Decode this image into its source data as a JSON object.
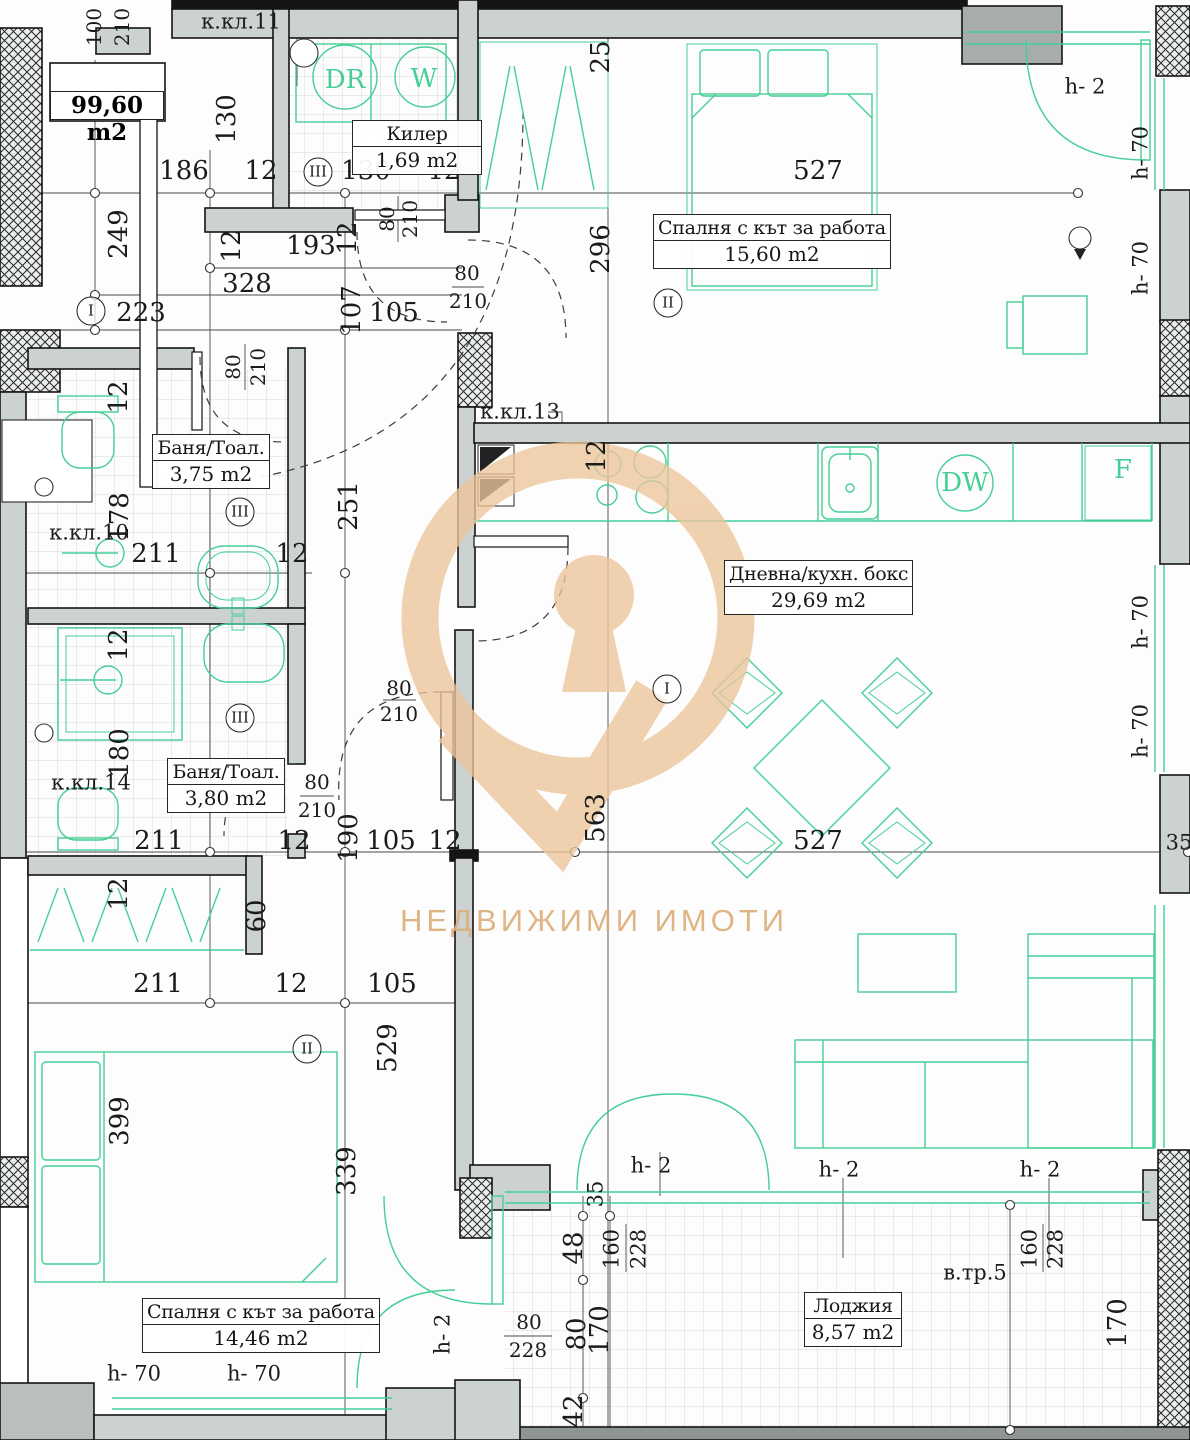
{
  "title": "apartment-floor-plan",
  "total_area": "99,60 m2",
  "watermark": {
    "text": "НЕДВИЖИМИ ИМОТИ",
    "color": "#ecc49a"
  },
  "accent_green": "#45cf96",
  "rooms": [
    {
      "name": "Килер",
      "area": "1,69 m2",
      "x": 352,
      "y": 120,
      "w": 128
    },
    {
      "name": "Спалня с кът за работа",
      "area": "15,60 m2",
      "x": 653,
      "y": 214,
      "w": 224
    },
    {
      "name": "Баня/Тоал.",
      "area": "3,75 m2",
      "x": 152,
      "y": 434,
      "w": 116
    },
    {
      "name": "Дневна/кухн. бокс",
      "area": "29,69 m2",
      "x": 724,
      "y": 560,
      "w": 178
    },
    {
      "name": "Баня/Тоал.",
      "area": "3,80 m2",
      "x": 167,
      "y": 758,
      "w": 116
    },
    {
      "name": "Спалня с кът за работа",
      "area": "14,46 m2",
      "x": 142,
      "y": 1298,
      "w": 224
    },
    {
      "name": "Лоджия",
      "area": "8,57 m2",
      "x": 804,
      "y": 1292,
      "w": 96
    }
  ],
  "markers": [
    {
      "t": "I",
      "x": 91,
      "y": 311
    },
    {
      "t": "III",
      "x": 318,
      "y": 172
    },
    {
      "t": "II",
      "x": 668,
      "y": 303
    },
    {
      "t": "III",
      "x": 240,
      "y": 512
    },
    {
      "t": "I",
      "x": 667,
      "y": 689
    },
    {
      "t": "III",
      "x": 240,
      "y": 718
    },
    {
      "t": "II",
      "x": 307,
      "y": 1049
    }
  ],
  "labels": [
    {
      "t": "186",
      "x": 184,
      "y": 171
    },
    {
      "t": "12",
      "x": 261,
      "y": 171
    },
    {
      "t": "130",
      "x": 366,
      "y": 171
    },
    {
      "t": "12",
      "x": 444,
      "y": 171
    },
    {
      "t": "527",
      "x": 818,
      "y": 171
    },
    {
      "t": "25",
      "x": 601,
      "y": 57,
      "r": 1
    },
    {
      "t": "100",
      "x": 94,
      "y": 27,
      "r": 1,
      "s": "sm"
    },
    {
      "t": "210",
      "x": 122,
      "y": 27,
      "r": 1,
      "s": "sm"
    },
    {
      "t": "130",
      "x": 227,
      "y": 119,
      "r": 1
    },
    {
      "t": "249",
      "x": 119,
      "y": 234,
      "r": 1
    },
    {
      "t": "12",
      "x": 232,
      "y": 246,
      "r": 1
    },
    {
      "t": "193",
      "x": 311,
      "y": 246
    },
    {
      "t": "12",
      "x": 348,
      "y": 238,
      "r": 1
    },
    {
      "t": "328",
      "x": 247,
      "y": 284
    },
    {
      "t": "80",
      "x": 387,
      "y": 219,
      "r": 1,
      "s": "sm"
    },
    {
      "t": "210",
      "x": 410,
      "y": 219,
      "r": 1,
      "s": "sm"
    },
    {
      "t": "223",
      "x": 141,
      "y": 313
    },
    {
      "t": "107",
      "x": 352,
      "y": 310,
      "r": 1
    },
    {
      "t": "105",
      "x": 394,
      "y": 313
    },
    {
      "t": "80",
      "x": 467,
      "y": 273,
      "s": "sm"
    },
    {
      "t": "210",
      "x": 468,
      "y": 301,
      "s": "sm"
    },
    {
      "t": "296",
      "x": 601,
      "y": 249,
      "r": 1
    },
    {
      "t": "h- 2",
      "x": 1085,
      "y": 87,
      "s": "md",
      "n": "height-label"
    },
    {
      "t": "h- 70",
      "x": 1141,
      "y": 153,
      "r": 1,
      "s": "md",
      "n": "height-label"
    },
    {
      "t": "h- 70",
      "x": 1141,
      "y": 268,
      "r": 1,
      "s": "md",
      "n": "height-label"
    },
    {
      "t": "к.кл.11",
      "x": 241,
      "y": 22,
      "s": "md",
      "n": "shaft-label"
    },
    {
      "t": "к.кл.13",
      "x": 520,
      "y": 412,
      "s": "md",
      "n": "shaft-label"
    },
    {
      "t": "DR",
      "x": 345,
      "y": 80,
      "c": 1,
      "n": "dryer-label"
    },
    {
      "t": "W",
      "x": 424,
      "y": 79,
      "c": 1,
      "n": "washer-label"
    },
    {
      "t": "12",
      "x": 119,
      "y": 397,
      "r": 1
    },
    {
      "t": "178",
      "x": 120,
      "y": 517,
      "r": 1
    },
    {
      "t": "80",
      "x": 233,
      "y": 367,
      "r": 1,
      "s": "sm"
    },
    {
      "t": "210",
      "x": 258,
      "y": 367,
      "r": 1,
      "s": "sm"
    },
    {
      "t": "к.кл.10",
      "x": 89,
      "y": 533,
      "s": "md",
      "n": "shaft-label"
    },
    {
      "t": "211",
      "x": 156,
      "y": 554
    },
    {
      "t": "12",
      "x": 292,
      "y": 554
    },
    {
      "t": "251",
      "x": 349,
      "y": 506,
      "r": 1
    },
    {
      "t": "12",
      "x": 597,
      "y": 456,
      "r": 1
    },
    {
      "t": "DW",
      "x": 965,
      "y": 483,
      "c": 1,
      "n": "dishwasher-label"
    },
    {
      "t": "F",
      "x": 1123,
      "y": 470,
      "c": 1,
      "n": "fridge-label"
    },
    {
      "t": "12",
      "x": 119,
      "y": 645,
      "r": 1
    },
    {
      "t": "180",
      "x": 120,
      "y": 753,
      "r": 1
    },
    {
      "t": "к.кл.14",
      "x": 91,
      "y": 783,
      "s": "md",
      "n": "shaft-label"
    },
    {
      "t": "80",
      "x": 317,
      "y": 782,
      "s": "sm"
    },
    {
      "t": "210",
      "x": 317,
      "y": 810,
      "s": "sm"
    },
    {
      "t": "80",
      "x": 399,
      "y": 688,
      "s": "sm"
    },
    {
      "t": "210",
      "x": 399,
      "y": 714,
      "s": "sm"
    },
    {
      "t": "211",
      "x": 159,
      "y": 841
    },
    {
      "t": "12",
      "x": 294,
      "y": 841
    },
    {
      "t": "190",
      "x": 349,
      "y": 838,
      "r": 1
    },
    {
      "t": "105",
      "x": 391,
      "y": 841
    },
    {
      "t": "12",
      "x": 445,
      "y": 841
    },
    {
      "t": "563",
      "x": 596,
      "y": 818,
      "r": 1
    },
    {
      "t": "527",
      "x": 818,
      "y": 841
    },
    {
      "t": "35",
      "x": 1179,
      "y": 843,
      "s": "md"
    },
    {
      "t": "h- 70",
      "x": 1141,
      "y": 622,
      "r": 1,
      "s": "md",
      "n": "height-label"
    },
    {
      "t": "h- 70",
      "x": 1141,
      "y": 731,
      "r": 1,
      "s": "md",
      "n": "height-label"
    },
    {
      "t": "12",
      "x": 119,
      "y": 894,
      "r": 1
    },
    {
      "t": "60",
      "x": 257,
      "y": 916,
      "r": 1
    },
    {
      "t": "211",
      "x": 158,
      "y": 984
    },
    {
      "t": "12",
      "x": 291,
      "y": 984
    },
    {
      "t": "105",
      "x": 392,
      "y": 984
    },
    {
      "t": "529",
      "x": 388,
      "y": 1048,
      "r": 1
    },
    {
      "t": "399",
      "x": 120,
      "y": 1121,
      "r": 1
    },
    {
      "t": "339",
      "x": 347,
      "y": 1171,
      "r": 1
    },
    {
      "t": "h- 2",
      "x": 651,
      "y": 1166,
      "s": "md",
      "n": "height-label"
    },
    {
      "t": "35",
      "x": 596,
      "y": 1194,
      "r": 1,
      "s": "md"
    },
    {
      "t": "48",
      "x": 574,
      "y": 1248,
      "r": 1
    },
    {
      "t": "160",
      "x": 612,
      "y": 1249,
      "r": 1,
      "s": "md"
    },
    {
      "t": "228",
      "x": 639,
      "y": 1249,
      "r": 1,
      "s": "md"
    },
    {
      "t": "h- 2",
      "x": 839,
      "y": 1170,
      "s": "md",
      "n": "height-label"
    },
    {
      "t": "160",
      "x": 1030,
      "y": 1249,
      "r": 1,
      "s": "md"
    },
    {
      "t": "228",
      "x": 1056,
      "y": 1249,
      "r": 1,
      "s": "md"
    },
    {
      "t": "h- 2",
      "x": 1040,
      "y": 1170,
      "s": "md",
      "n": "height-label"
    },
    {
      "t": "80",
      "x": 529,
      "y": 1322,
      "s": "sm"
    },
    {
      "t": "228",
      "x": 528,
      "y": 1350,
      "s": "sm"
    },
    {
      "t": "80",
      "x": 577,
      "y": 1334,
      "r": 1
    },
    {
      "t": "170",
      "x": 600,
      "y": 1330,
      "r": 1
    },
    {
      "t": "42",
      "x": 574,
      "y": 1411,
      "r": 1
    },
    {
      "t": "h- 2",
      "x": 443,
      "y": 1334,
      "r": 1,
      "s": "md",
      "n": "height-label"
    },
    {
      "t": "170",
      "x": 1118,
      "y": 1323,
      "r": 1
    },
    {
      "t": "в.тр.5",
      "x": 975,
      "y": 1273,
      "s": "md",
      "n": "stair-label"
    },
    {
      "t": "h- 70",
      "x": 134,
      "y": 1374,
      "s": "md",
      "n": "height-label"
    },
    {
      "t": "h- 70",
      "x": 254,
      "y": 1374,
      "s": "md",
      "n": "height-label"
    }
  ]
}
